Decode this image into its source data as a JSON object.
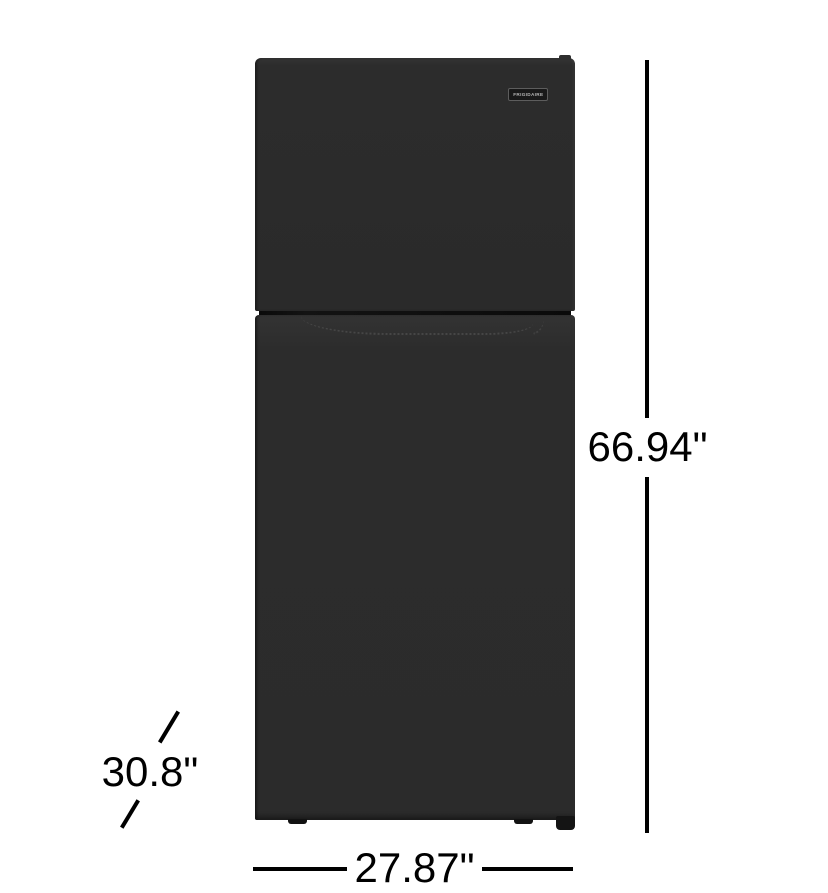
{
  "image": {
    "description": "Front view of a black Frigidaire top-freezer refrigerator with dimension callouts"
  },
  "logo": {
    "text": "FRIGIDAIRE"
  },
  "dimensions": {
    "height": "66.94\"",
    "width": "27.87\"",
    "depth": "30.8\""
  },
  "colors": {
    "background": "#ffffff",
    "appliance_body": "#2b2b2b",
    "dimension_line": "#000000",
    "dimension_text": "#000000"
  }
}
